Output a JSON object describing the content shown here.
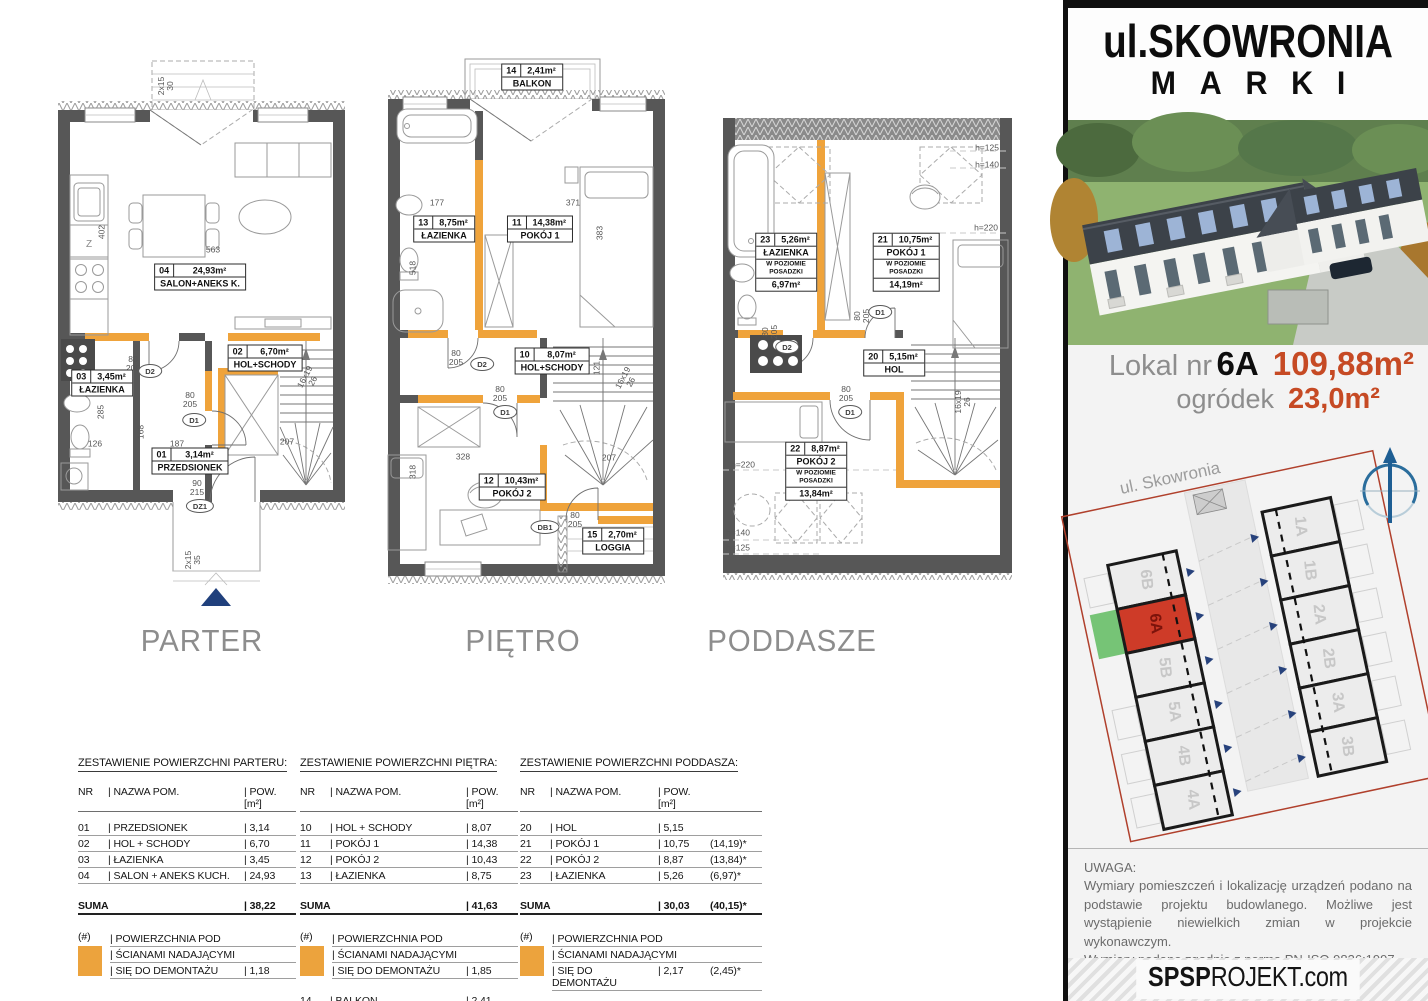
{
  "panel": {
    "title1": "ul.SKOWRONIA",
    "title2": "MARKI",
    "lokal_label": "Lokal nr",
    "lokal_value": "6A",
    "area_main": "109,88m²",
    "garden_label": "ogródek",
    "garden_value": "23,0m²",
    "street": "ul. Skowronia",
    "units_left": [
      "6B",
      "6A",
      "5B",
      "5A",
      "4B",
      "4A"
    ],
    "units_right": [
      "1A",
      "1B",
      "2A",
      "2B",
      "3A",
      "3B"
    ],
    "highlighted_unit": "6A",
    "uwaga_title": "UWAGA:",
    "uwaga_p1": "Wymiary pomieszczeń i lokalizację urządzeń podano na podstawie projektu budowlanego. Możliwe jest wystąpienie niewielkich zmian w projekcie wykonawczym.",
    "uwaga_p2": "Wymiary podano zgodnie z normą PN-ISO 9836:1997",
    "footer_bold": "SPSP",
    "footer_rest": "ROJEKT.com"
  },
  "colors": {
    "wall_orange": "#efa33b",
    "area_red": "#c64a24",
    "unit_red": "#ce3b28",
    "garden_green": "#76c476",
    "entry_navy": "#20407c",
    "plot_outline": "#b0402c"
  },
  "floors": {
    "parter": {
      "title": "PARTER",
      "salon_nr": "04",
      "salon_area": "24,93m²",
      "salon_name": "SALON+ANEKS K.",
      "hol_nr": "02",
      "hol_area": "6,70m²",
      "hol_name": "HOL+SCHODY",
      "laz_nr": "03",
      "laz_area": "3,45m²",
      "laz_name": "ŁAZIENKA",
      "przed_nr": "01",
      "przed_area": "3,14m²",
      "przed_name": "PRZEDSIONEK",
      "d1": "D1",
      "d2": "D2",
      "dz1": "DZ1",
      "dim_d1": "80\n205",
      "dim_d2": "80\n205",
      "dim_dz1": "90\n215",
      "dim_563": "563",
      "dim_402": "402",
      "dim_285": "285",
      "dim_126": "126",
      "dim_168": "168",
      "dim_187": "187",
      "dim_207": "207",
      "dim_stairs": "16x19\n26",
      "dim_top": "2x15\n30",
      "dim_entry": "2x15\n35",
      "kitchen_z": "Z"
    },
    "pietro": {
      "title": "PIĘTRO",
      "balkon_nr": "14",
      "balkon_area": "2,41m²",
      "balkon_name": "BALKON",
      "laz_nr": "13",
      "laz_area": "8,75m²",
      "laz_name": "ŁAZIENKA",
      "p1_nr": "11",
      "p1_area": "14,38m²",
      "p1_name": "POKÓJ 1",
      "hol_nr": "10",
      "hol_area": "8,07m²",
      "hol_name": "HOL+SCHODY",
      "p2_nr": "12",
      "p2_area": "10,43m²",
      "p2_name": "POKÓJ 2",
      "loggia_nr": "15",
      "loggia_area": "2,70m²",
      "loggia_name": "LOGGIA",
      "d1": "D1",
      "d2": "D2",
      "db1": "DB1",
      "dim_door": "80\n205",
      "dim_177": "177",
      "dim_371": "371",
      "dim_383": "383",
      "dim_518": "518",
      "dim_121": "121",
      "dim_328": "328",
      "dim_318": "318",
      "dim_207": "207",
      "dim_stairs": "16x19\n26"
    },
    "poddasze": {
      "title": "PODDASZE",
      "laz_nr": "23",
      "laz_area": "5,26m²",
      "laz_name": "ŁAZIENKA",
      "laz_sub": "W POZIOMIE\nPOSADZKI",
      "laz_floor": "6,97m²",
      "p1_nr": "21",
      "p1_area": "10,75m²",
      "p1_name": "POKÓJ 1",
      "p1_sub": "W POZIOMIE\nPOSADZKI",
      "p1_floor": "14,19m²",
      "hol_nr": "20",
      "hol_area": "5,15m²",
      "hol_name": "HOL",
      "p2_nr": "22",
      "p2_area": "8,87m²",
      "p2_name": "POKÓJ 2",
      "p2_sub": "W POZIOMIE\nPOSADZKI",
      "p2_floor": "13,84m²",
      "d1": "D1",
      "d2": "D2",
      "dim_door": "80\n205",
      "h125": "h=125",
      "h140": "h=140",
      "h220": "h=220",
      "dim_stairs": "16x19\n26"
    }
  },
  "tables": [
    {
      "title": "ZESTAWIENIE POWIERZCHNI PARTERU:",
      "h_nr": "NR",
      "h_name": "| NAZWA POM.",
      "h_pow": "| POW. [m²]",
      "rows": [
        {
          "nr": "01",
          "name": "| PRZEDSIONEK",
          "pow": "| 3,14",
          "extra": ""
        },
        {
          "nr": "02",
          "name": "| HOL + SCHODY",
          "pow": "| 6,70",
          "extra": ""
        },
        {
          "nr": "03",
          "name": "| ŁAZIENKA",
          "pow": "| 3,45",
          "extra": ""
        },
        {
          "nr": "04",
          "name": "| SALON + ANEKS KUCH.",
          "pow": "| 24,93",
          "extra": ""
        }
      ],
      "suma_label": "SUMA",
      "suma": "| 38,22",
      "suma_extra": "",
      "legend_sym": "(#)",
      "legend_l1": "| POWIERZCHNIA POD",
      "legend_l2": "| ŚCIANAMI NADAJĄCYMI",
      "legend_l3": "| SIĘ DO DEMONTAŻU",
      "legend_val": "| 1,18",
      "legend_extra": "",
      "note": ""
    },
    {
      "title": "ZESTAWIENIE POWIERZCHNI PIĘTRA:",
      "h_nr": "NR",
      "h_name": "| NAZWA POM.",
      "h_pow": "| POW. [m²]",
      "rows": [
        {
          "nr": "10",
          "name": "| HOL + SCHODY",
          "pow": "| 8,07",
          "extra": ""
        },
        {
          "nr": "11",
          "name": "| POKÓJ 1",
          "pow": "| 14,38",
          "extra": ""
        },
        {
          "nr": "12",
          "name": "| POKÓJ 2",
          "pow": "| 10,43",
          "extra": ""
        },
        {
          "nr": "13",
          "name": "| ŁAZIENKA",
          "pow": "| 8,75",
          "extra": ""
        }
      ],
      "suma_label": "SUMA",
      "suma": "| 41,63",
      "suma_extra": "",
      "legend_sym": "(#)",
      "legend_l1": "| POWIERZCHNIA POD",
      "legend_l2": "| ŚCIANAMI NADAJĄCYMI",
      "legend_l3": "| SIĘ DO DEMONTAŻU",
      "legend_val": "| 1,85",
      "legend_extra": "",
      "extra_rows": [
        {
          "nr": "14",
          "name": "| BALKON",
          "pow": "| 2,41"
        },
        {
          "nr": "15",
          "name": "| LOGGIA",
          "pow": "| 2,70"
        }
      ],
      "note": ""
    },
    {
      "title": "ZESTAWIENIE POWIERZCHNI PODDASZA:",
      "h_nr": "NR",
      "h_name": "| NAZWA POM.",
      "h_pow": "| POW. [m²]",
      "rows": [
        {
          "nr": "20",
          "name": "| HOL",
          "pow": "| 5,15",
          "extra": ""
        },
        {
          "nr": "21",
          "name": "| POKÓJ 1",
          "pow": "| 10,75",
          "extra": "(14,19)*"
        },
        {
          "nr": "22",
          "name": "| POKÓJ 2",
          "pow": "| 8,87",
          "extra": "(13,84)*"
        },
        {
          "nr": "23",
          "name": "| ŁAZIENKA",
          "pow": "| 5,26",
          "extra": "(6,97)*"
        }
      ],
      "suma_label": "SUMA",
      "suma": "| 30,03",
      "suma_extra": "(40,15)*",
      "legend_sym": "(#)",
      "legend_l1": "| POWIERZCHNIA POD",
      "legend_l2": "| ŚCIANAMI NADAJĄCYMI",
      "legend_l3": "| SIĘ DO DEMONTAŻU",
      "legend_val": "| 2,17",
      "legend_extra": "(2,45)*",
      "note": "(...)* - POWIERZCHNIE LICZONE W POZIOMIE POSADZKI,\nNIE WLICZONE DO POWIERZCHNI UŻYTKOWEJ"
    }
  ]
}
